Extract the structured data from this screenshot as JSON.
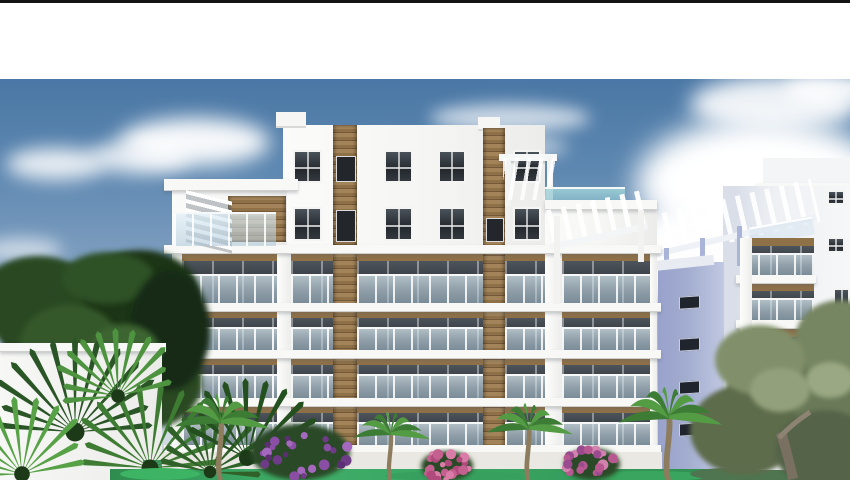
{
  "page": {
    "top_bar": {
      "present": true
    },
    "header_band": {
      "present": true,
      "text": ""
    }
  },
  "photo": {
    "type": "architectural-render",
    "subject": "New-build white apartment complex with wood accent panels, glass balconies and rooftop pergolas, surrounded by palm trees, an olive tree and purple and pink bougainvillea under a blue sky with clouds",
    "elements": [
      "sky",
      "clouds",
      "main-apartment-building",
      "right-apartment-building",
      "wood-accent-strips",
      "glass-balconies",
      "pergolas",
      "windows",
      "dark-leafy-tree",
      "fan-palms",
      "palm-trees",
      "olive-tree",
      "bougainvillea-bushes",
      "lawn",
      "low-white-wall"
    ]
  },
  "colors": {
    "top_bar": "#141414",
    "header": "#ffffff",
    "sky_top": "#4a77a5",
    "sky_horizon": "#d8dfe5",
    "cloud": "#ffffff",
    "wall": "#f5f5f3",
    "wall_shade": "#e7e7e5",
    "slab": "#f8f8f6",
    "wood": "#8f7148",
    "wood_light": "#a3845a",
    "wood_dark": "#75593a",
    "window_glass": "#23282d",
    "frame": "#f4f4f2",
    "balcony_glass": "#cfe2ec",
    "terrace_glass": "#9fd3d8",
    "rb_wall": "#a3adcf",
    "rb_wall_light": "#c0c8e2",
    "rb_front": "#eef0f4",
    "tree_dark": "#243e1e",
    "tree_mid": "#2b4a22",
    "tree_light": "#35592b",
    "palm_dark": "#2a5526",
    "palm_mid": "#3f7c33",
    "palm_bright": "#57a246",
    "olive": "#6b7a58",
    "olive_light": "#93a07b",
    "olive_trunk": "#7a7061",
    "palm_trunk": "#8d7c5e",
    "bougainvillea": "#8a4fa5",
    "bougainvillea_dark": "#5c2f73",
    "flower_pink": "#da7ca8",
    "flower_pink_dark": "#b14a7c",
    "lawn": "#3fae69",
    "walkway": "#eae8e2",
    "teal_door": "#3e9e6d"
  }
}
